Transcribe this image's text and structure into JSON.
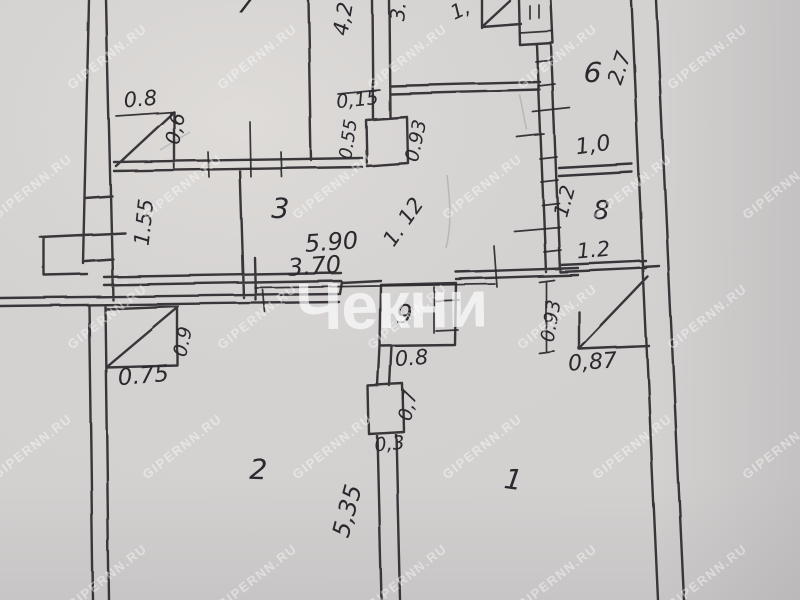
{
  "document": {
    "kind": "hand-drawn apartment floor plan photo"
  },
  "colors": {
    "paper": "#d3d1d0",
    "ink": "#2a282c",
    "watermark": "#ffffff"
  },
  "watermark": {
    "tile": "GIPERNN.RU",
    "center": "Чекни"
  },
  "rooms": [
    {
      "n": "7"
    },
    {
      "n": "3"
    },
    {
      "n": "6"
    },
    {
      "n": "8"
    },
    {
      "n": "9"
    },
    {
      "n": "2"
    },
    {
      "n": "1"
    }
  ],
  "dims": {
    "d_08_top": "0.8",
    "d_06": "0,6",
    "d_155": "1.55",
    "d_42": "4,2",
    "d_3dot": "3.",
    "d_015": "0,15",
    "d_055": "0.55",
    "d_093_top": "0.93",
    "d_1comma": "1,",
    "d_27": "2.7",
    "d_10": "1,0",
    "d_12_side": "1.2",
    "d_12_bottom": "1.2",
    "d_590": "5.90",
    "d_370": "3.70",
    "d_112": "1. 12",
    "d_08_mid": "0.8",
    "d_07": "0,7",
    "d_03": "0,3",
    "d_075": "0.75",
    "d_09": "0.9",
    "d_093_room1": "0.93",
    "d_087": "0,87",
    "d_535": "5,35"
  }
}
